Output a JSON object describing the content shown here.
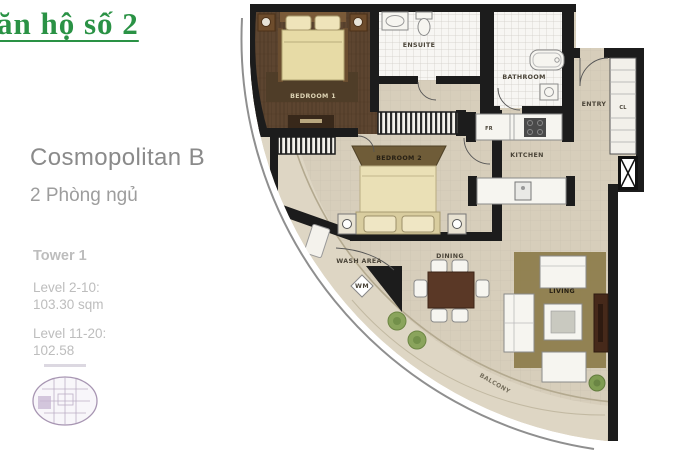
{
  "colors": {
    "green": "#2a9245",
    "gray-title": "#8a8a8a",
    "gray-sub": "#9d9d9d",
    "gray-light": "#bdbdbd",
    "wall": "#1c1c1c",
    "floor": "#d7cebb",
    "balcony": "#ded6c4",
    "wood": "#5d4530",
    "keyplan": "#a795b2"
  },
  "header": {
    "title": "ăn hộ số 2"
  },
  "info": {
    "name": "Cosmopolitan B",
    "bedrooms": "2 Phòng ngủ",
    "tower": "Tower 1",
    "levels": [
      {
        "range": "Level 2-10:",
        "area": "103.30 sqm"
      },
      {
        "range": "Level 11-20:",
        "area": "102.58"
      }
    ]
  },
  "plan": {
    "labels": {
      "bedroom1": "BEDROOM 1",
      "bedroom2": "BEDROOM 2",
      "ensuite": "ENSUITE",
      "bathroom": "BATHROOM",
      "entry": "ENTRY",
      "closet": "CL",
      "fridge": "FR",
      "kitchen": "KITCHEN",
      "wash_area": "WASH AREA",
      "washer": "WM",
      "dining": "DINING",
      "living": "LIVING",
      "balcony": "BALCONY"
    }
  }
}
